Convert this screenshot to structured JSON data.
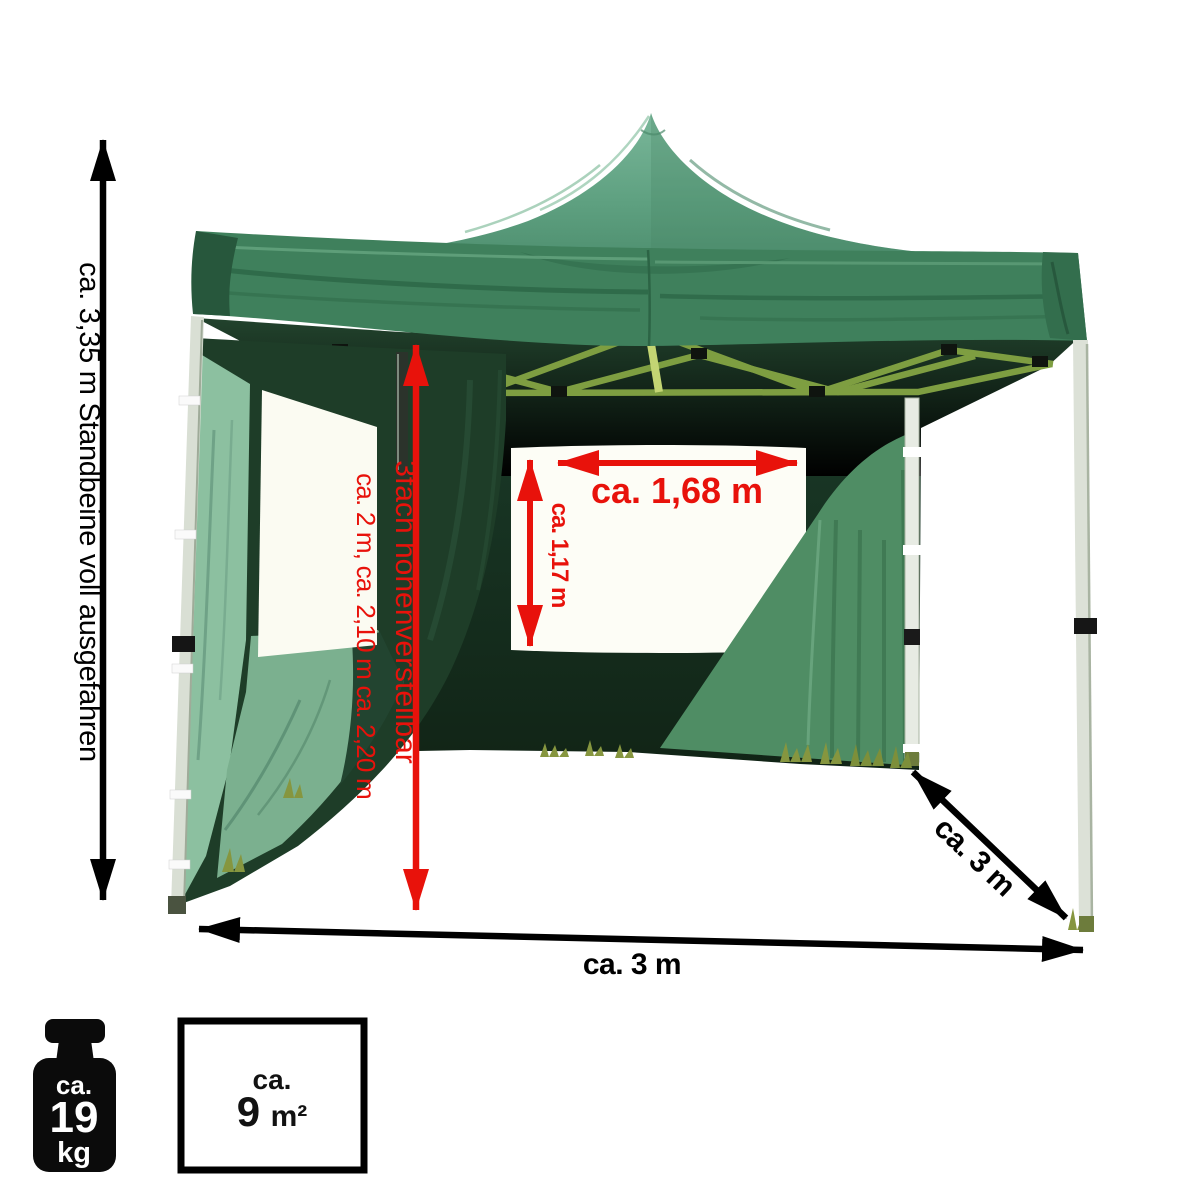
{
  "figure": {
    "description": "Green pop-up pavilion tent product photo with dimension annotations"
  },
  "annotations": {
    "leg_height": "ca. 3,35 m Standbeine voll ausgefahren",
    "height_adjust_label": "3fach höhenverstellbar",
    "height_adjust_values": "ca. 2 m, ca. 2,10 m ca. 2,20 m",
    "window_width": "ca. 1,68 m",
    "window_height": "ca. 1,17 m",
    "base_width": "ca. 3 m",
    "base_depth": "ca. 3 m"
  },
  "badges": {
    "weight": {
      "approx": "ca.",
      "value": "19",
      "unit": "kg"
    },
    "area": {
      "approx": "ca.",
      "value": "9",
      "unit": "m²"
    }
  },
  "colors": {
    "annotation_red": "#e8120b",
    "annotation_black": "#000000",
    "canopy_light": "#6fb093",
    "canopy_green": "#3f805c",
    "interior_dark": "#152d1c",
    "wall_sunlit": "#4f8d64",
    "panel_light": "#8cc0a0",
    "truss_olive": "#7e9e41",
    "leg_aluminum": "#d9dfd4"
  }
}
